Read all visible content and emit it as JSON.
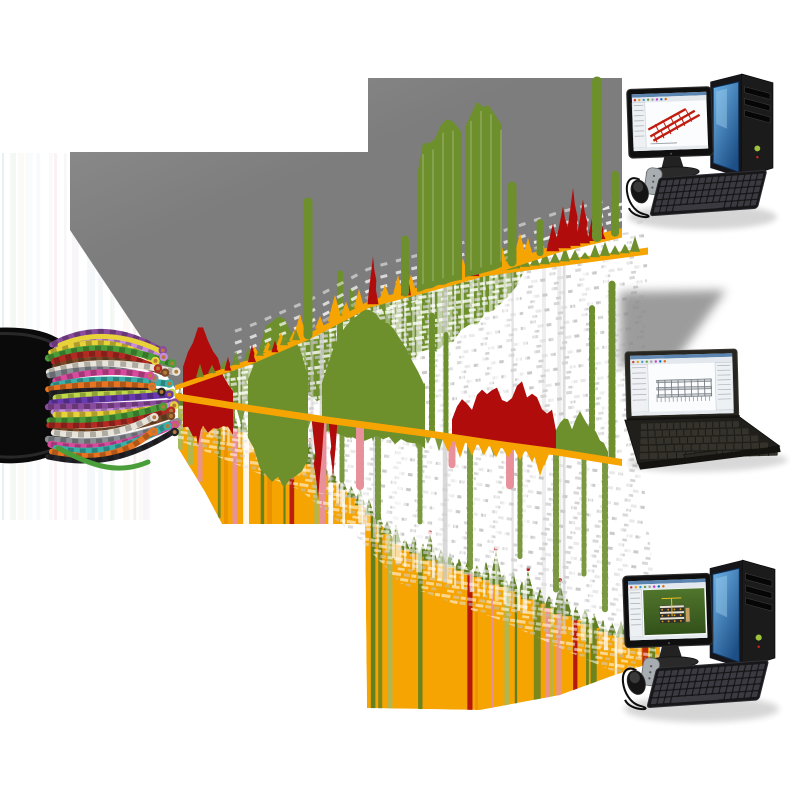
{
  "meta": {
    "description": "Concept illustration: a stripped multi-wire copper cable streams measurement signal data (noise, spectra, alarm spikes) across three fanned signal bands into three computers running CAD structural-analysis software",
    "background": "#ffffff",
    "canvas": {
      "width": 800,
      "height": 800
    }
  },
  "palette": {
    "gray": "#7d7d7d",
    "grayTop": "#8f8f8f",
    "green": "#6d8f2c",
    "greenDark": "#5e7f21",
    "greenLight": "#cdddb0",
    "greenPale": "#9dbb66",
    "orange": "#f6a402",
    "orangeDeep": "#e89000",
    "red": "#b00c0c",
    "pink": "#e8919b",
    "noiseWhite": "#ffffff",
    "noiseGray": "#c4c4c4",
    "jacket": "#0a0a0a",
    "copper": "#b5793a",
    "towerBlue1": "#6db3e8",
    "towerBlue2": "#1d4f86",
    "deviceDark": "#161616",
    "keyGray": "#3a3a40",
    "screenBg": "#fbfcfd",
    "screenTitle": "#5b84b0",
    "screenToolbar": "#e2e8ee",
    "cadRed": "#c01d10",
    "cadGray": "#787e84",
    "cadGreen1": "#50752c",
    "cadGreen2": "#32511a"
  },
  "left_streaks": {
    "x0": 2,
    "x1": 150,
    "y0": 153,
    "y1": 520,
    "seed": 7,
    "colors": [
      "#cfe0ea",
      "#e8e0d0",
      "#f0d8d8",
      "#dce8dc",
      "#e6eef4",
      "#f4e8e0",
      "#d8e4ee",
      "#eee6ee"
    ]
  },
  "gray_wedge": {
    "top_outline": [
      [
        70,
        152
      ],
      [
        368,
        152
      ],
      [
        368,
        78
      ],
      [
        622,
        78
      ],
      [
        622,
        233
      ]
    ],
    "left_edge": [
      [
        70,
        230
      ],
      [
        70,
        156
      ]
    ]
  },
  "bands": {
    "b1": {
      "baseline": [
        [
          175,
          388
        ],
        [
          250,
          362
        ],
        [
          310,
          336
        ],
        [
          370,
          304
        ],
        [
          430,
          288
        ],
        [
          500,
          268
        ],
        [
          560,
          248
        ],
        [
          622,
          233
        ]
      ],
      "thickness": [
        5,
        9
      ],
      "green_blocks": [
        {
          "x0": 417,
          "x1": 462,
          "profile": [
            [
              417,
              118
            ],
            [
              424,
              148
            ],
            [
              432,
              144
            ],
            [
              440,
              158
            ],
            [
              450,
              163
            ],
            [
              462,
              146
            ]
          ]
        },
        {
          "x0": 465,
          "x1": 502,
          "profile": [
            [
              465,
              148
            ],
            [
              472,
              166
            ],
            [
              480,
              171
            ],
            [
              490,
              166
            ],
            [
              502,
              144
            ]
          ]
        }
      ],
      "green_cols": [
        [
          308,
          9,
          135
        ],
        [
          405,
          8,
          55
        ],
        [
          512,
          9,
          78
        ],
        [
          540,
          7,
          32
        ],
        [
          597,
          10,
          158
        ],
        [
          615,
          8,
          60
        ]
      ],
      "red_spikes": [
        [
          228,
          7,
          14
        ],
        [
          252,
          8,
          18
        ],
        [
          275,
          7,
          12
        ],
        [
          373,
          11,
          48
        ],
        [
          406,
          10,
          50
        ],
        [
          475,
          9,
          20
        ],
        [
          553,
          13,
          28
        ],
        [
          563,
          16,
          42
        ],
        [
          573,
          15,
          58
        ],
        [
          583,
          14,
          44
        ],
        [
          593,
          11,
          28
        ],
        [
          601,
          9,
          18
        ]
      ],
      "below_green": {
        "x0": 212,
        "x1": 525,
        "depth": [
          [
            212,
            38
          ],
          [
            260,
            50
          ],
          [
            310,
            62
          ],
          [
            370,
            72
          ],
          [
            440,
            62
          ],
          [
            480,
            50
          ],
          [
            525,
            12
          ]
        ]
      }
    },
    "b1b": {
      "line": [
        [
          430,
          281
        ],
        [
          648,
          251
        ]
      ],
      "teeth_from": 505,
      "teeth_to": 645
    },
    "b2": {
      "baseline": [
        [
          175,
          396
        ],
        [
          250,
          408
        ],
        [
          330,
          420
        ],
        [
          420,
          432
        ],
        [
          500,
          444
        ],
        [
          560,
          452
        ],
        [
          622,
          462
        ]
      ],
      "green_block_a": {
        "x0": 248,
        "x1": 308,
        "up": [
          [
            248,
            30
          ],
          [
            258,
            60
          ],
          [
            268,
            85
          ],
          [
            278,
            94
          ],
          [
            290,
            88
          ],
          [
            300,
            70
          ],
          [
            308,
            40
          ]
        ],
        "down": [
          [
            248,
            30
          ],
          [
            260,
            55
          ],
          [
            272,
            68
          ],
          [
            284,
            72
          ],
          [
            296,
            60
          ],
          [
            308,
            45
          ]
        ]
      },
      "green_block_b": {
        "x0": 322,
        "x1": 425,
        "up": [
          [
            322,
            40
          ],
          [
            335,
            80
          ],
          [
            345,
            100
          ],
          [
            358,
            110
          ],
          [
            370,
            112
          ],
          [
            385,
            105
          ],
          [
            400,
            92
          ],
          [
            412,
            75
          ],
          [
            425,
            50
          ]
        ],
        "down": 13
      },
      "green_jag_right": [
        [
          556,
          20
        ],
        [
          564,
          38
        ],
        [
          572,
          25
        ],
        [
          580,
          45
        ],
        [
          590,
          30
        ],
        [
          600,
          18
        ],
        [
          608,
          8
        ]
      ],
      "red_up_profile": [
        [
          452,
          16
        ],
        [
          462,
          40
        ],
        [
          472,
          30
        ],
        [
          480,
          55
        ],
        [
          488,
          44
        ],
        [
          496,
          62
        ],
        [
          504,
          38
        ],
        [
          512,
          50
        ],
        [
          520,
          68
        ],
        [
          528,
          46
        ],
        [
          536,
          58
        ],
        [
          545,
          30
        ],
        [
          552,
          40
        ],
        [
          558,
          12
        ]
      ],
      "red_tip_up": [
        [
          183,
          28
        ],
        [
          192,
          55
        ],
        [
          200,
          72
        ],
        [
          208,
          62
        ],
        [
          216,
          46
        ],
        [
          224,
          30
        ],
        [
          233,
          14
        ]
      ],
      "red_down": [
        [
          318,
          13,
          82
        ],
        [
          333,
          9,
          58
        ],
        [
          198,
          16,
          46
        ]
      ],
      "pink_cols": [
        [
          322,
          9,
          70
        ],
        [
          360,
          8,
          62
        ],
        [
          452,
          7,
          30
        ],
        [
          510,
          8,
          40
        ]
      ],
      "green_cols_up": [
        [
          340,
          6,
          148
        ],
        [
          352,
          5,
          132
        ],
        [
          432,
          6,
          118
        ],
        [
          446,
          5,
          102
        ],
        [
          592,
          6,
          150
        ],
        [
          612,
          7,
          178
        ]
      ],
      "green_cols_down": [
        [
          232,
          6,
          60
        ],
        [
          252,
          6,
          95
        ],
        [
          270,
          5,
          80
        ],
        [
          298,
          6,
          110
        ],
        [
          342,
          5,
          70
        ],
        [
          378,
          6,
          120
        ],
        [
          420,
          5,
          90
        ],
        [
          470,
          6,
          130
        ],
        [
          520,
          5,
          110
        ],
        [
          556,
          6,
          140
        ],
        [
          584,
          5,
          120
        ],
        [
          605,
          6,
          150
        ]
      ]
    },
    "b3": {
      "top": [
        [
          178,
          402
        ],
        [
          240,
          428
        ],
        [
          300,
          452
        ],
        [
          360,
          502
        ],
        [
          400,
          545
        ],
        [
          460,
          568
        ],
        [
          500,
          582
        ],
        [
          560,
          610
        ],
        [
          610,
          632
        ],
        [
          660,
          642
        ]
      ],
      "bottom": [
        [
          178,
          448
        ],
        [
          205,
          492
        ],
        [
          222,
          524
        ],
        [
          365,
          524
        ],
        [
          367,
          708
        ],
        [
          480,
          710
        ],
        [
          560,
          695
        ],
        [
          612,
          676
        ],
        [
          660,
          660
        ]
      ],
      "stripe_seed": 11,
      "stripe_palette": [
        [
          "#5e7f21",
          0.2
        ],
        [
          "#b00c0c",
          0.09
        ],
        [
          "#ffffff",
          0.12
        ],
        [
          "#e8919b",
          0.05
        ],
        [
          "#9dbb66",
          0.08
        ],
        [
          "#e89000",
          0.06
        ]
      ],
      "big_teeth": [
        [
          310,
          18
        ],
        [
          430,
          22
        ],
        [
          496,
          30
        ],
        [
          528,
          24
        ],
        [
          560,
          28
        ]
      ]
    }
  },
  "noise": {
    "seed": 5,
    "streak_count": 85
  },
  "cable": {
    "tip": [
      172,
      390
    ],
    "n_wires": 26,
    "seed": 3,
    "wire_colors": [
      "#8a4a9e",
      "#c78be0",
      "#e8d23a",
      "#4a9e3a",
      "#b22a22",
      "#7a4a28",
      "#e8e4da",
      "#8a8f96",
      "#d94a9e",
      "#3ab0a8",
      "#e87422",
      "#23232a",
      "#c0d84a",
      "#6a3ab0"
    ]
  },
  "computers": {
    "desktop_top": {
      "x": 626,
      "y": 70,
      "scale": 0.98,
      "screen": "red-truss"
    },
    "laptop": {
      "x": 625,
      "y": 352,
      "scale": 1.0,
      "screen": "gray-building",
      "wall_shadow": [
        [
          620,
          292
        ],
        [
          726,
          290
        ],
        [
          672,
          366
        ],
        [
          620,
          368
        ]
      ]
    },
    "desktop_bottom": {
      "x": 622,
      "y": 556,
      "scale": 1.02,
      "screen": "green-model"
    }
  }
}
